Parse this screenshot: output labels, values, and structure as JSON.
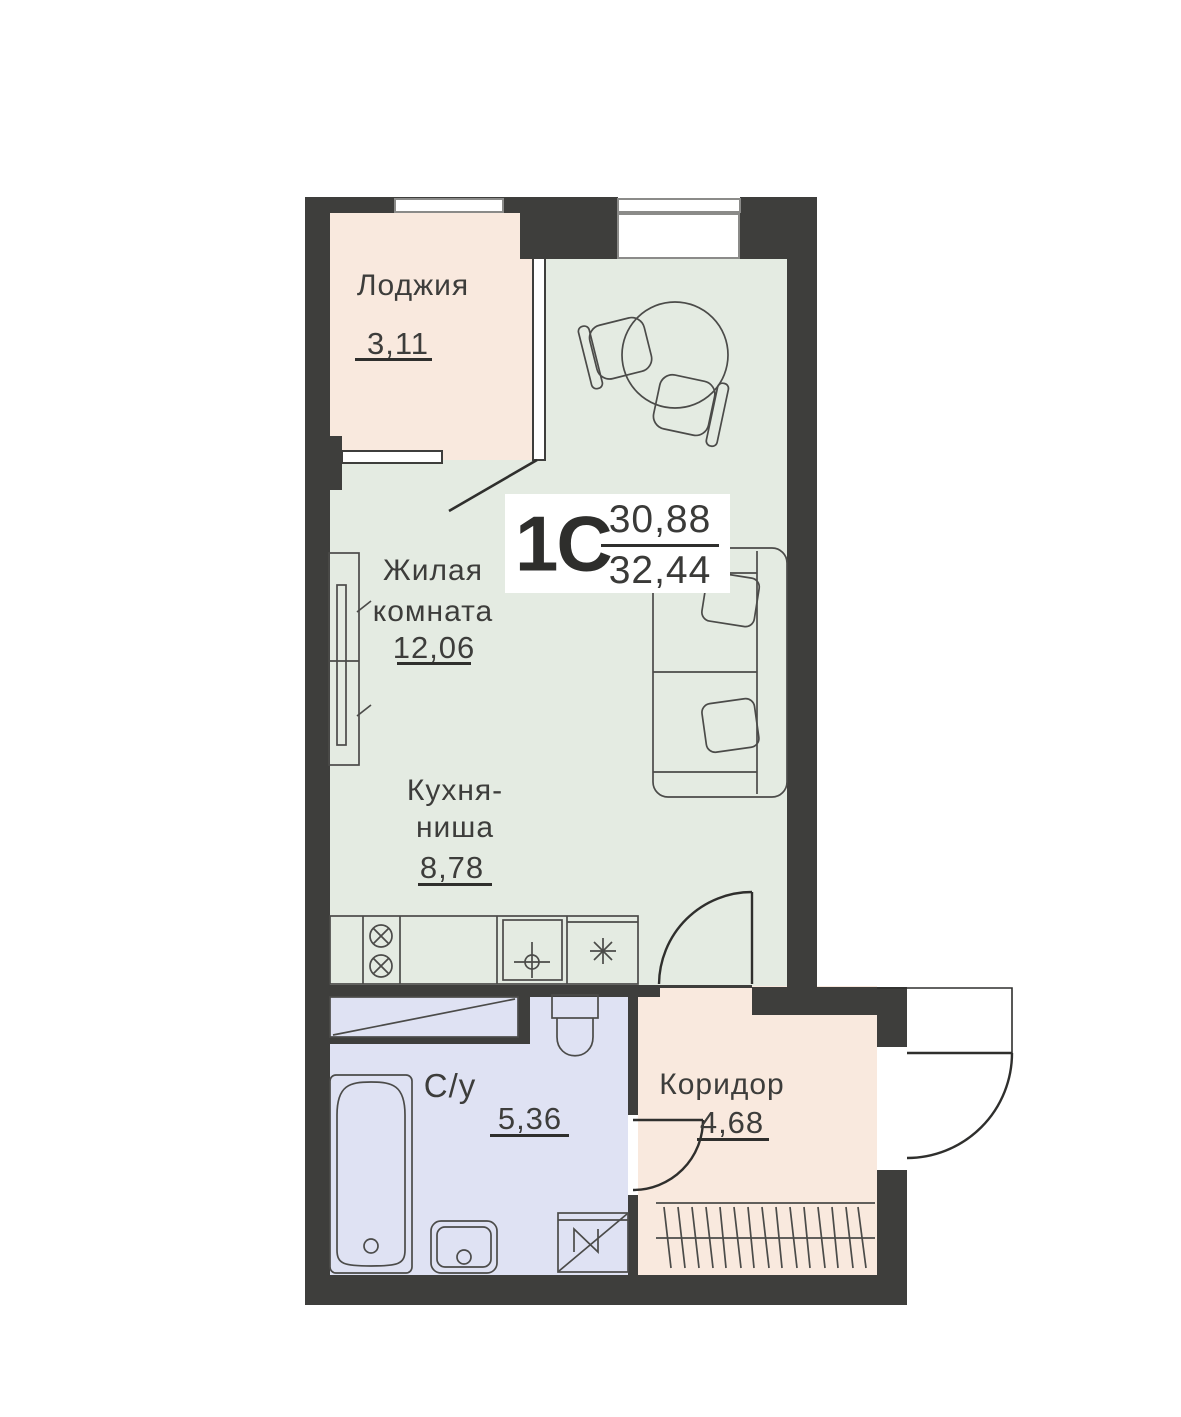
{
  "plan": {
    "unit": {
      "type": "1С",
      "living_area": "30,88",
      "total_area": "32,44"
    },
    "rooms": {
      "loggia": {
        "name": "Лоджия",
        "area": "3,11"
      },
      "living": {
        "name_line1": "Жилая",
        "name_line2": "комната",
        "area": "12,06"
      },
      "kitchen": {
        "name_line1": "Кухня-",
        "name_line2": "ниша",
        "area": "8,78"
      },
      "bathroom": {
        "name": "С/у",
        "area": "5,36"
      },
      "corridor": {
        "name": "Коридор",
        "area": "4,68"
      }
    },
    "colors": {
      "wall": "#3e3e3c",
      "floor_living": "#e4ebe2",
      "floor_loggia": "#f9e9de",
      "floor_bathroom": "#dfe2f3",
      "furniture_line": "#4b4b49",
      "door_line": "#2f2f2d",
      "window_line": "#8b8b89"
    }
  }
}
